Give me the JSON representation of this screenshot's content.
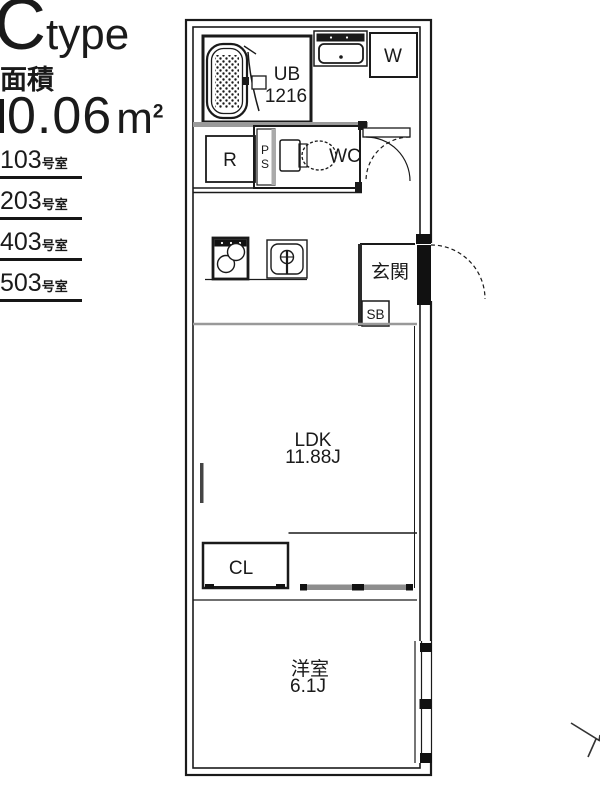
{
  "sidebar": {
    "type_big": "C",
    "type_small": "type",
    "area_caption": "面積",
    "area_value": "0.06",
    "area_unit": "m",
    "area_unit_sup": "2",
    "rooms": [
      {
        "number": "103",
        "suffix": "号室"
      },
      {
        "number": "203",
        "suffix": "号室"
      },
      {
        "number": "403",
        "suffix": "号室"
      },
      {
        "number": "503",
        "suffix": "号室"
      }
    ]
  },
  "plan": {
    "ub_line1": "UB",
    "ub_line2": "1216",
    "washer": "W",
    "fridge": "R",
    "ps_p": "P",
    "ps_s": "S",
    "wc": "WC",
    "genkan": "玄関",
    "shoe_box": "SB",
    "ldk": "LDK",
    "ldk_size": "11.88J",
    "closet": "CL",
    "bedroom": "洋室",
    "bedroom_size": "6.1J",
    "line_color": "#1a1a1a",
    "step_line_color": "#999999",
    "slider_color": "#8d8d8d"
  }
}
